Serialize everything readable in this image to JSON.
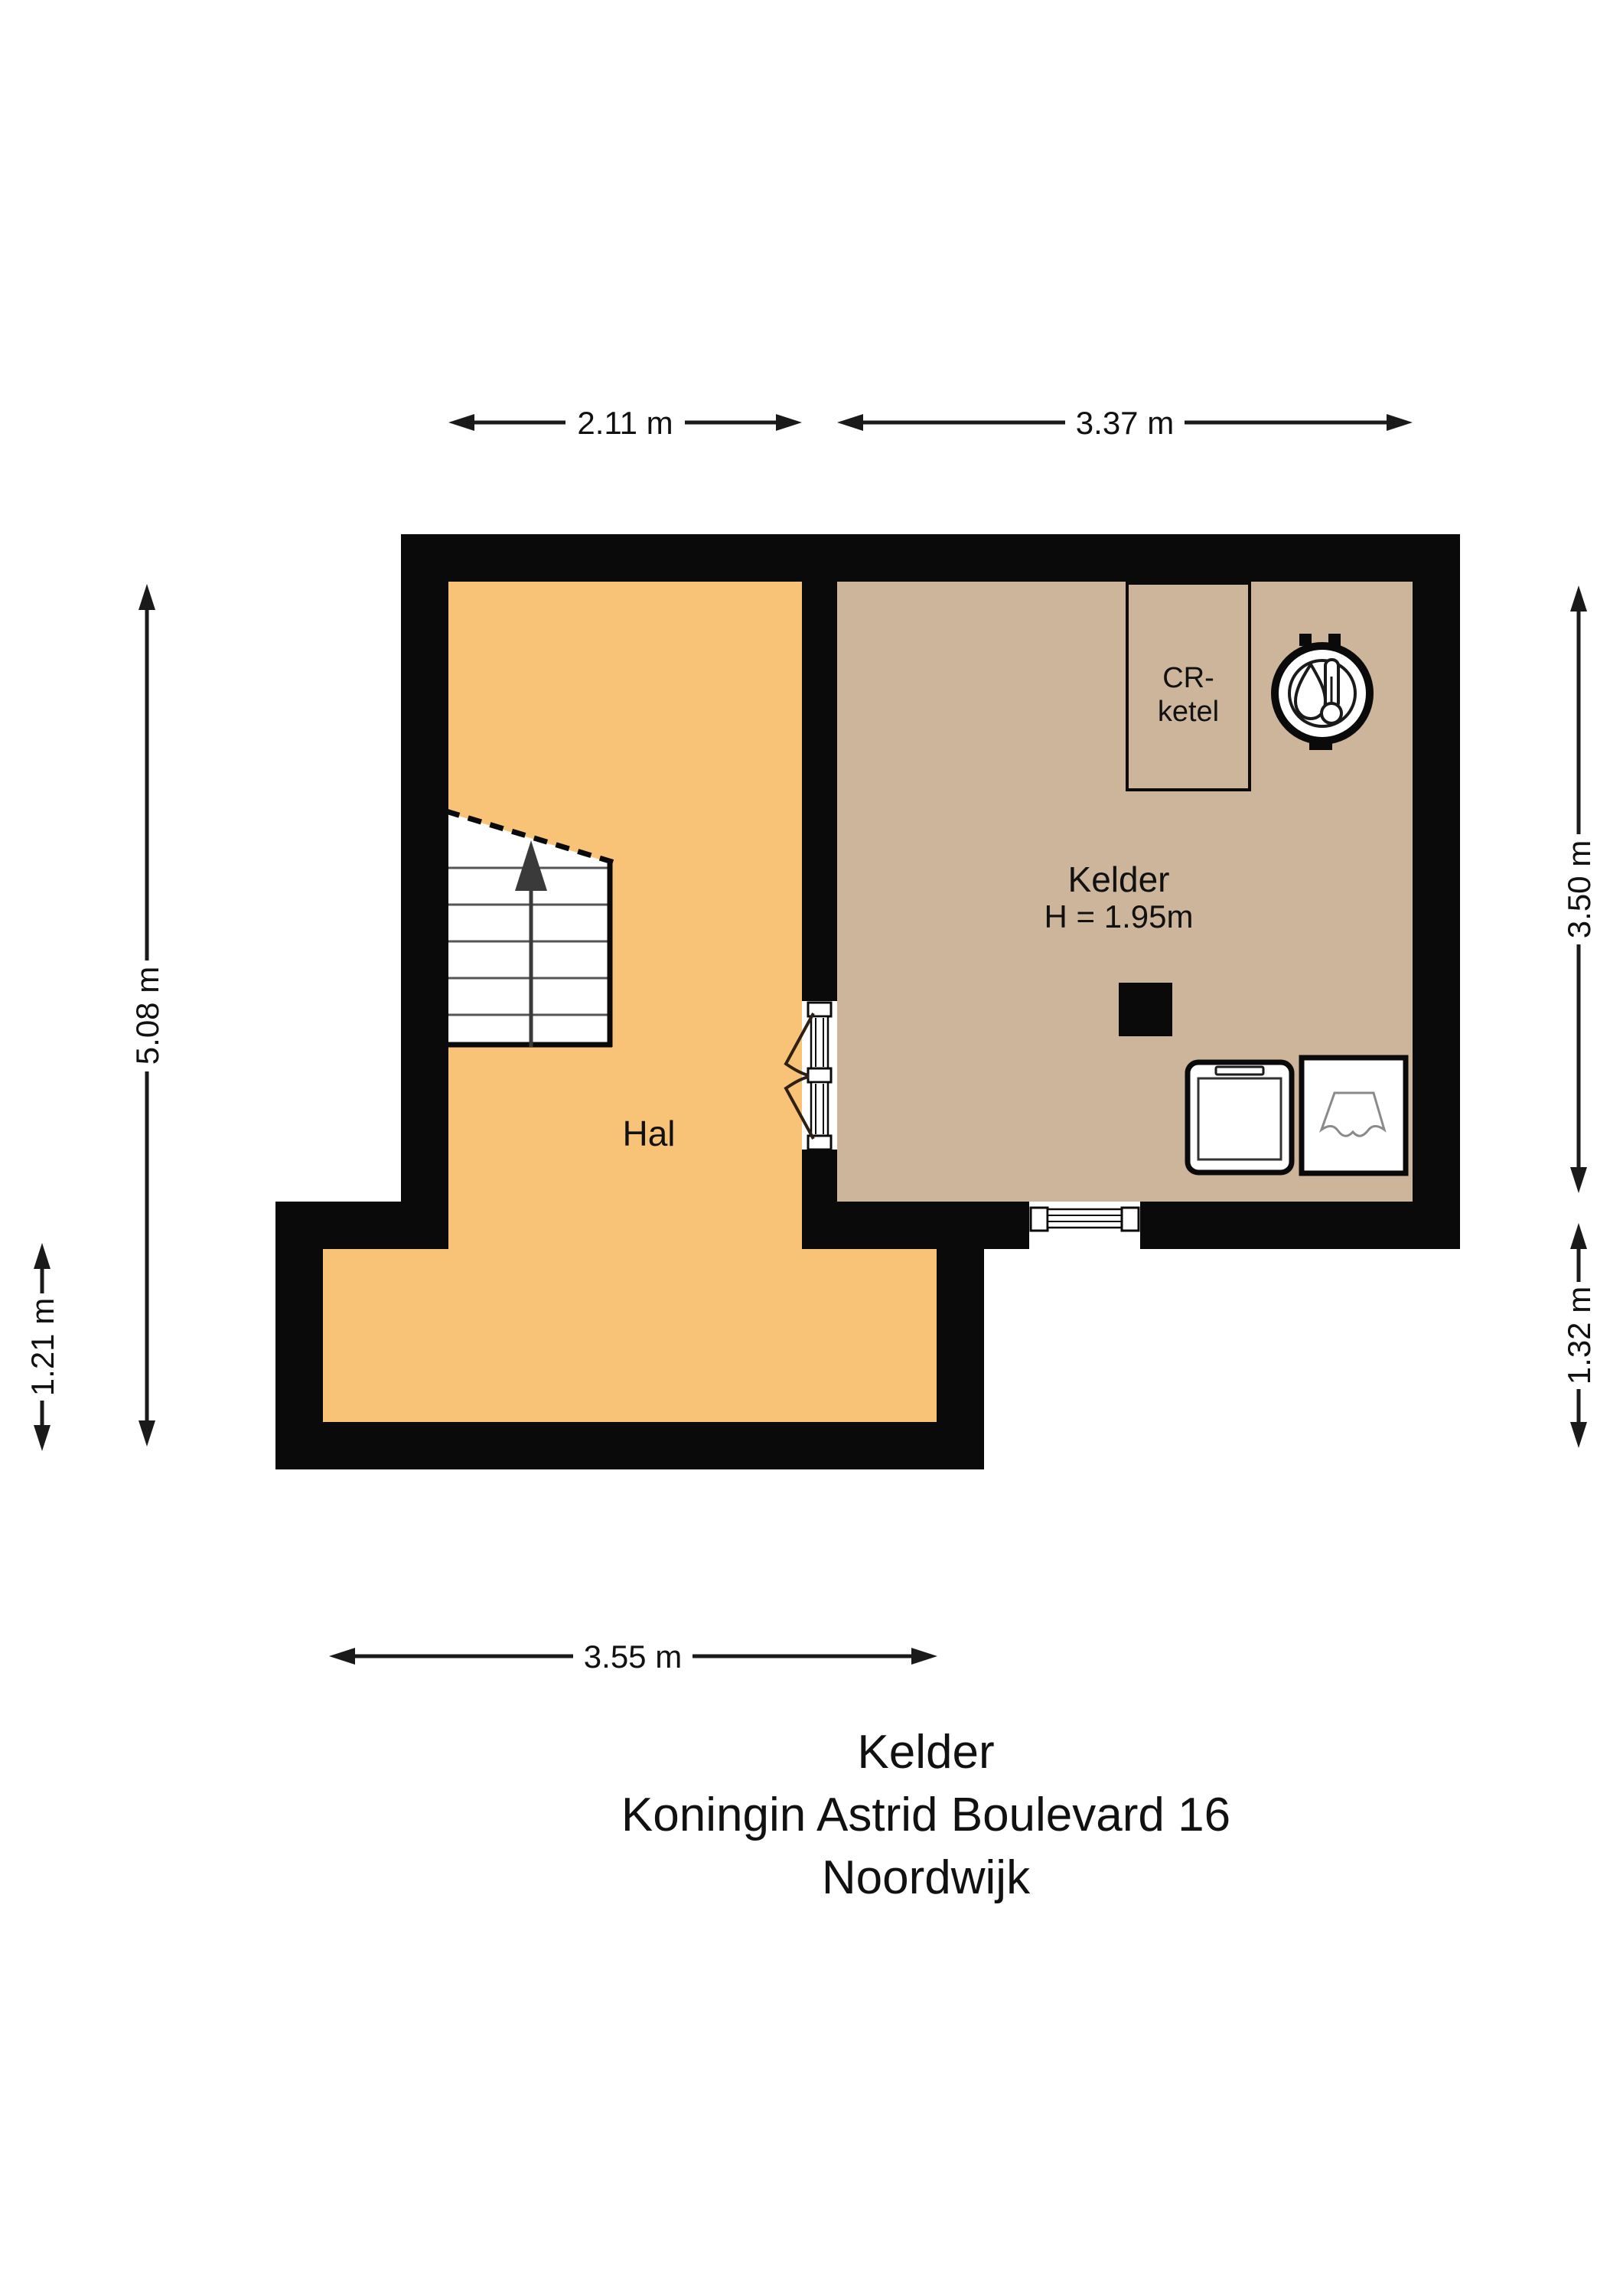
{
  "title_block": {
    "line1": "Kelder",
    "line2": "Koningin Astrid Boulevard 16",
    "line3": "Noordwijk"
  },
  "rooms": {
    "hal": {
      "label": "Hal"
    },
    "kelder": {
      "label": "Kelder",
      "height_label": "H = 1.95m"
    },
    "cr_ketel": {
      "label_line1": "CR-",
      "label_line2": "ketel"
    }
  },
  "dimensions": {
    "top_left": "2.11 m",
    "top_right": "3.37 m",
    "left_upper": "5.08 m",
    "left_lower": "1.21 m",
    "right_upper": "3.50 m",
    "right_lower": "1.32 m",
    "bottom": "3.55 m"
  },
  "colors": {
    "wall": "#0a0a0a",
    "hal_fill": "#F8C377",
    "kelder_fill": "#CDB59B",
    "stair_line": "#555555",
    "fixture_line": "#8a8a8a",
    "door_arc": "#2e2014",
    "dim_line": "#1a1a1a"
  },
  "icons": [
    "stairs-up-arrow-icon",
    "double-door-icon",
    "window-icon",
    "boiler-icon",
    "washing-machine-icon",
    "sink-icon",
    "column-marker"
  ]
}
